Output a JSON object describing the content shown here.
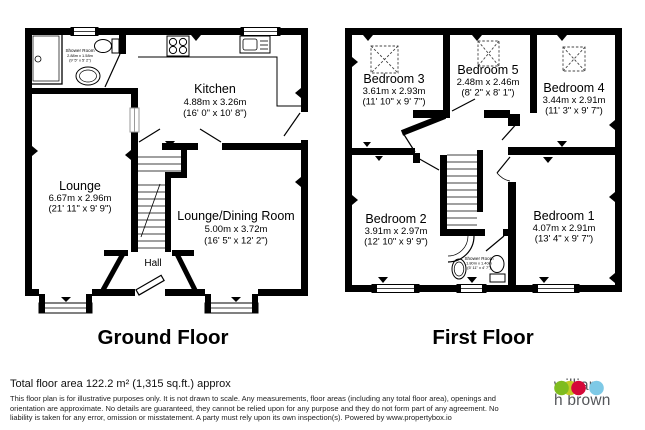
{
  "plan": {
    "ground": {
      "title": "Ground Floor",
      "rooms": {
        "shower": {
          "name": "Shower Room",
          "metric": "2.88m x 1.58m",
          "imperial": "(9' 5\" x 5' 2\")"
        },
        "kitchen": {
          "name": "Kitchen",
          "metric": "4.88m x 3.26m",
          "imperial": "(16' 0\" x 10' 8\")"
        },
        "lounge": {
          "name": "Lounge",
          "metric": "6.67m x 2.96m",
          "imperial": "(21' 11\" x 9' 9\")"
        },
        "dining": {
          "name": "Lounge/Dining Room",
          "metric": "5.00m x 3.72m",
          "imperial": "(16' 5\" x 12' 2\")"
        },
        "hall": {
          "name": "Hall"
        }
      }
    },
    "first": {
      "title": "First Floor",
      "rooms": {
        "bedroom3": {
          "name": "Bedroom 3",
          "metric": "3.61m x 2.93m",
          "imperial": "(11' 10\" x 9' 7\")"
        },
        "bedroom5": {
          "name": "Bedroom 5",
          "metric": "2.48m x 2.46m",
          "imperial": "(8' 2\" x 8' 1\")"
        },
        "bedroom4": {
          "name": "Bedroom 4",
          "metric": "3.44m x 2.91m",
          "imperial": "(11' 3\" x 9' 7\")"
        },
        "bedroom2": {
          "name": "Bedroom 2",
          "metric": "3.91m x 2.97m",
          "imperial": "(12' 10\" x 9' 9\")"
        },
        "bedroom1": {
          "name": "Bedroom 1",
          "metric": "4.07m x 2.91m",
          "imperial": "(13' 4\" x 9' 7\")"
        },
        "shower": {
          "name": "Shower Room",
          "metric": "1.80m x 1.40m",
          "imperial": "(5' 11\" x 4' 7\")"
        }
      }
    }
  },
  "footer": {
    "area": "Total floor area 122.2 m² (1,315 sq.ft.) approx",
    "disclaimer": "This floor plan is for illustrative purposes only. It is not drawn to scale. Any measurements, floor areas (including any total floor area), openings and orientation are approximate. No details are guaranteed, they cannot be relied upon for any purpose and they do not form part of any agreement. No liability is taken for any error, omission or misstatement. A party must rely upon its own inspection(s). Powered by www.propertybox.io"
  },
  "brand": {
    "name_line1": "william",
    "name_line2": "h brown",
    "colors": {
      "green": "#7fbc20",
      "yellow": "#c3cc27",
      "red": "#d50839",
      "blue": "#7ec9e6"
    }
  }
}
